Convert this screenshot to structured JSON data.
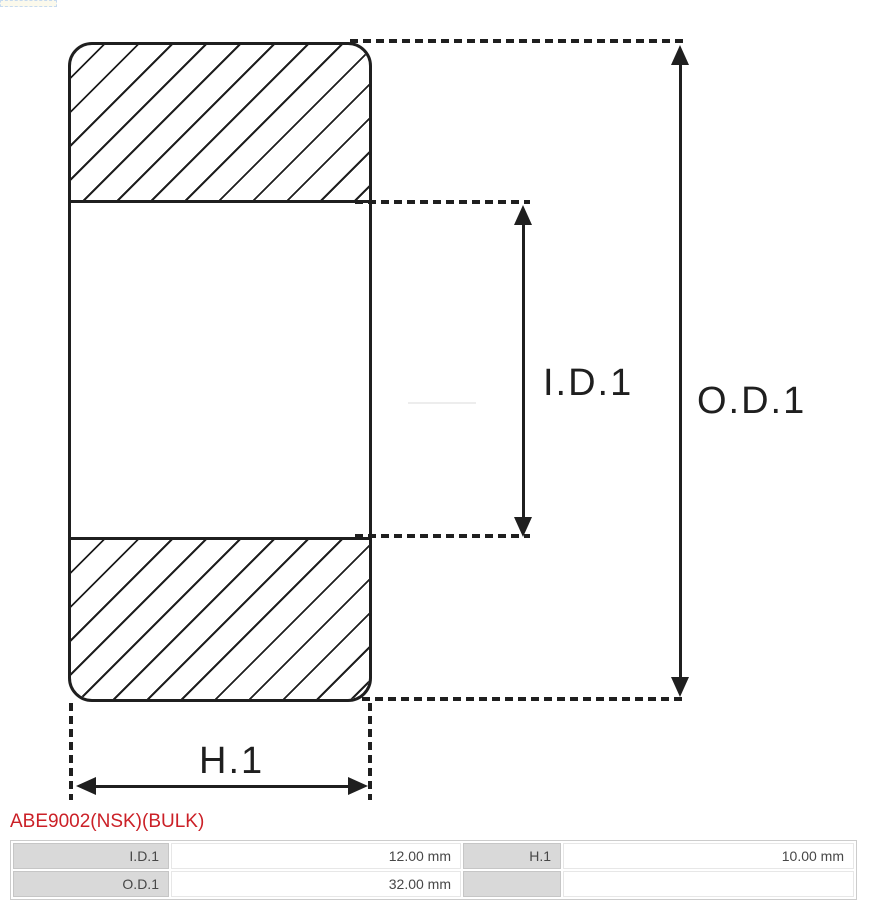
{
  "part": {
    "title": "ABE9002(NSK)(BULK)"
  },
  "diagram": {
    "labels": {
      "inner_diameter": "I.D.1",
      "outer_diameter": "O.D.1",
      "height": "H.1"
    }
  },
  "spec_table": {
    "rows": [
      [
        "I.D.1",
        "12.00 mm",
        "H.1",
        "10.00 mm"
      ],
      [
        "O.D.1",
        "32.00 mm",
        "",
        ""
      ]
    ]
  },
  "colors": {
    "accent_red": "#cb2027",
    "line_color": "#1f1f1f",
    "table_label_bg": "#d9d9d9"
  }
}
